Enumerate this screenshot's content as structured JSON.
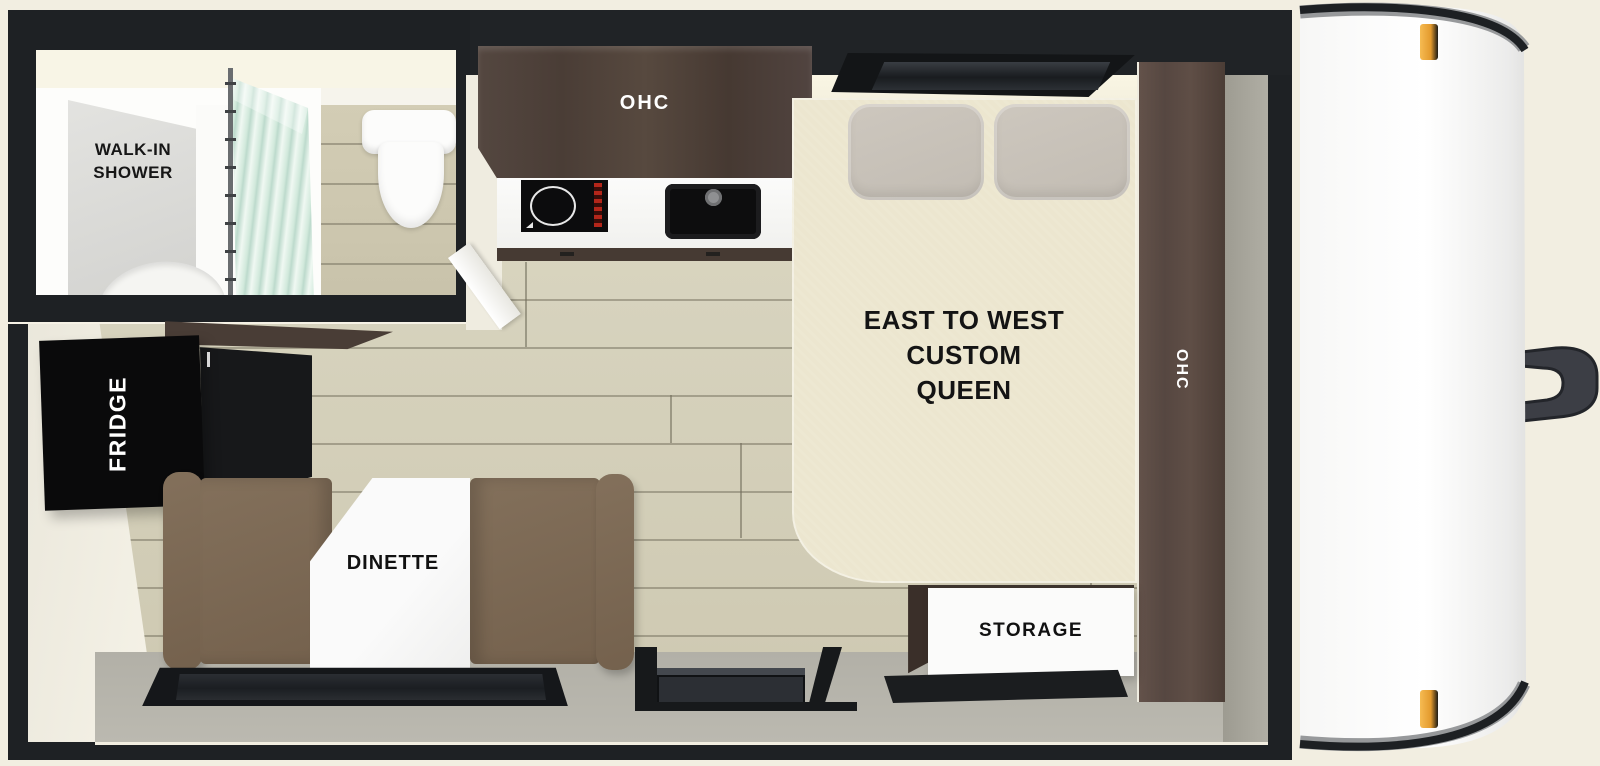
{
  "title": "Travel trailer floor plan",
  "labels": {
    "shower_line1": "WALK-IN",
    "shower_line2": "SHOWER",
    "kitchen_ohc": "OHC",
    "bed_line1": "EAST TO WEST",
    "bed_line2": "CUSTOM",
    "bed_line3": "QUEEN",
    "wardrobe_ohc": "OHC",
    "fridge": "FRIDGE",
    "dinette": "DINETTE",
    "storage": "STORAGE"
  },
  "colors": {
    "exterior": "#f2eee1",
    "walls": "#1e2124",
    "interior": "#efebdc",
    "floor": "#d5d0ba",
    "cabinet_dark": "#4a3d36",
    "wardrobe": "#5a4a42",
    "bench": "#7b6753",
    "bed": "#ece6cf",
    "pillow": "#c8c2b9",
    "fridge": "#0a0a0b",
    "table": "#fafafa",
    "lower_wall": "#b5b3aa",
    "front_cap": "#ffffff",
    "marker_light": "#e8a33d",
    "shower_curtain": "#d9ece3"
  }
}
